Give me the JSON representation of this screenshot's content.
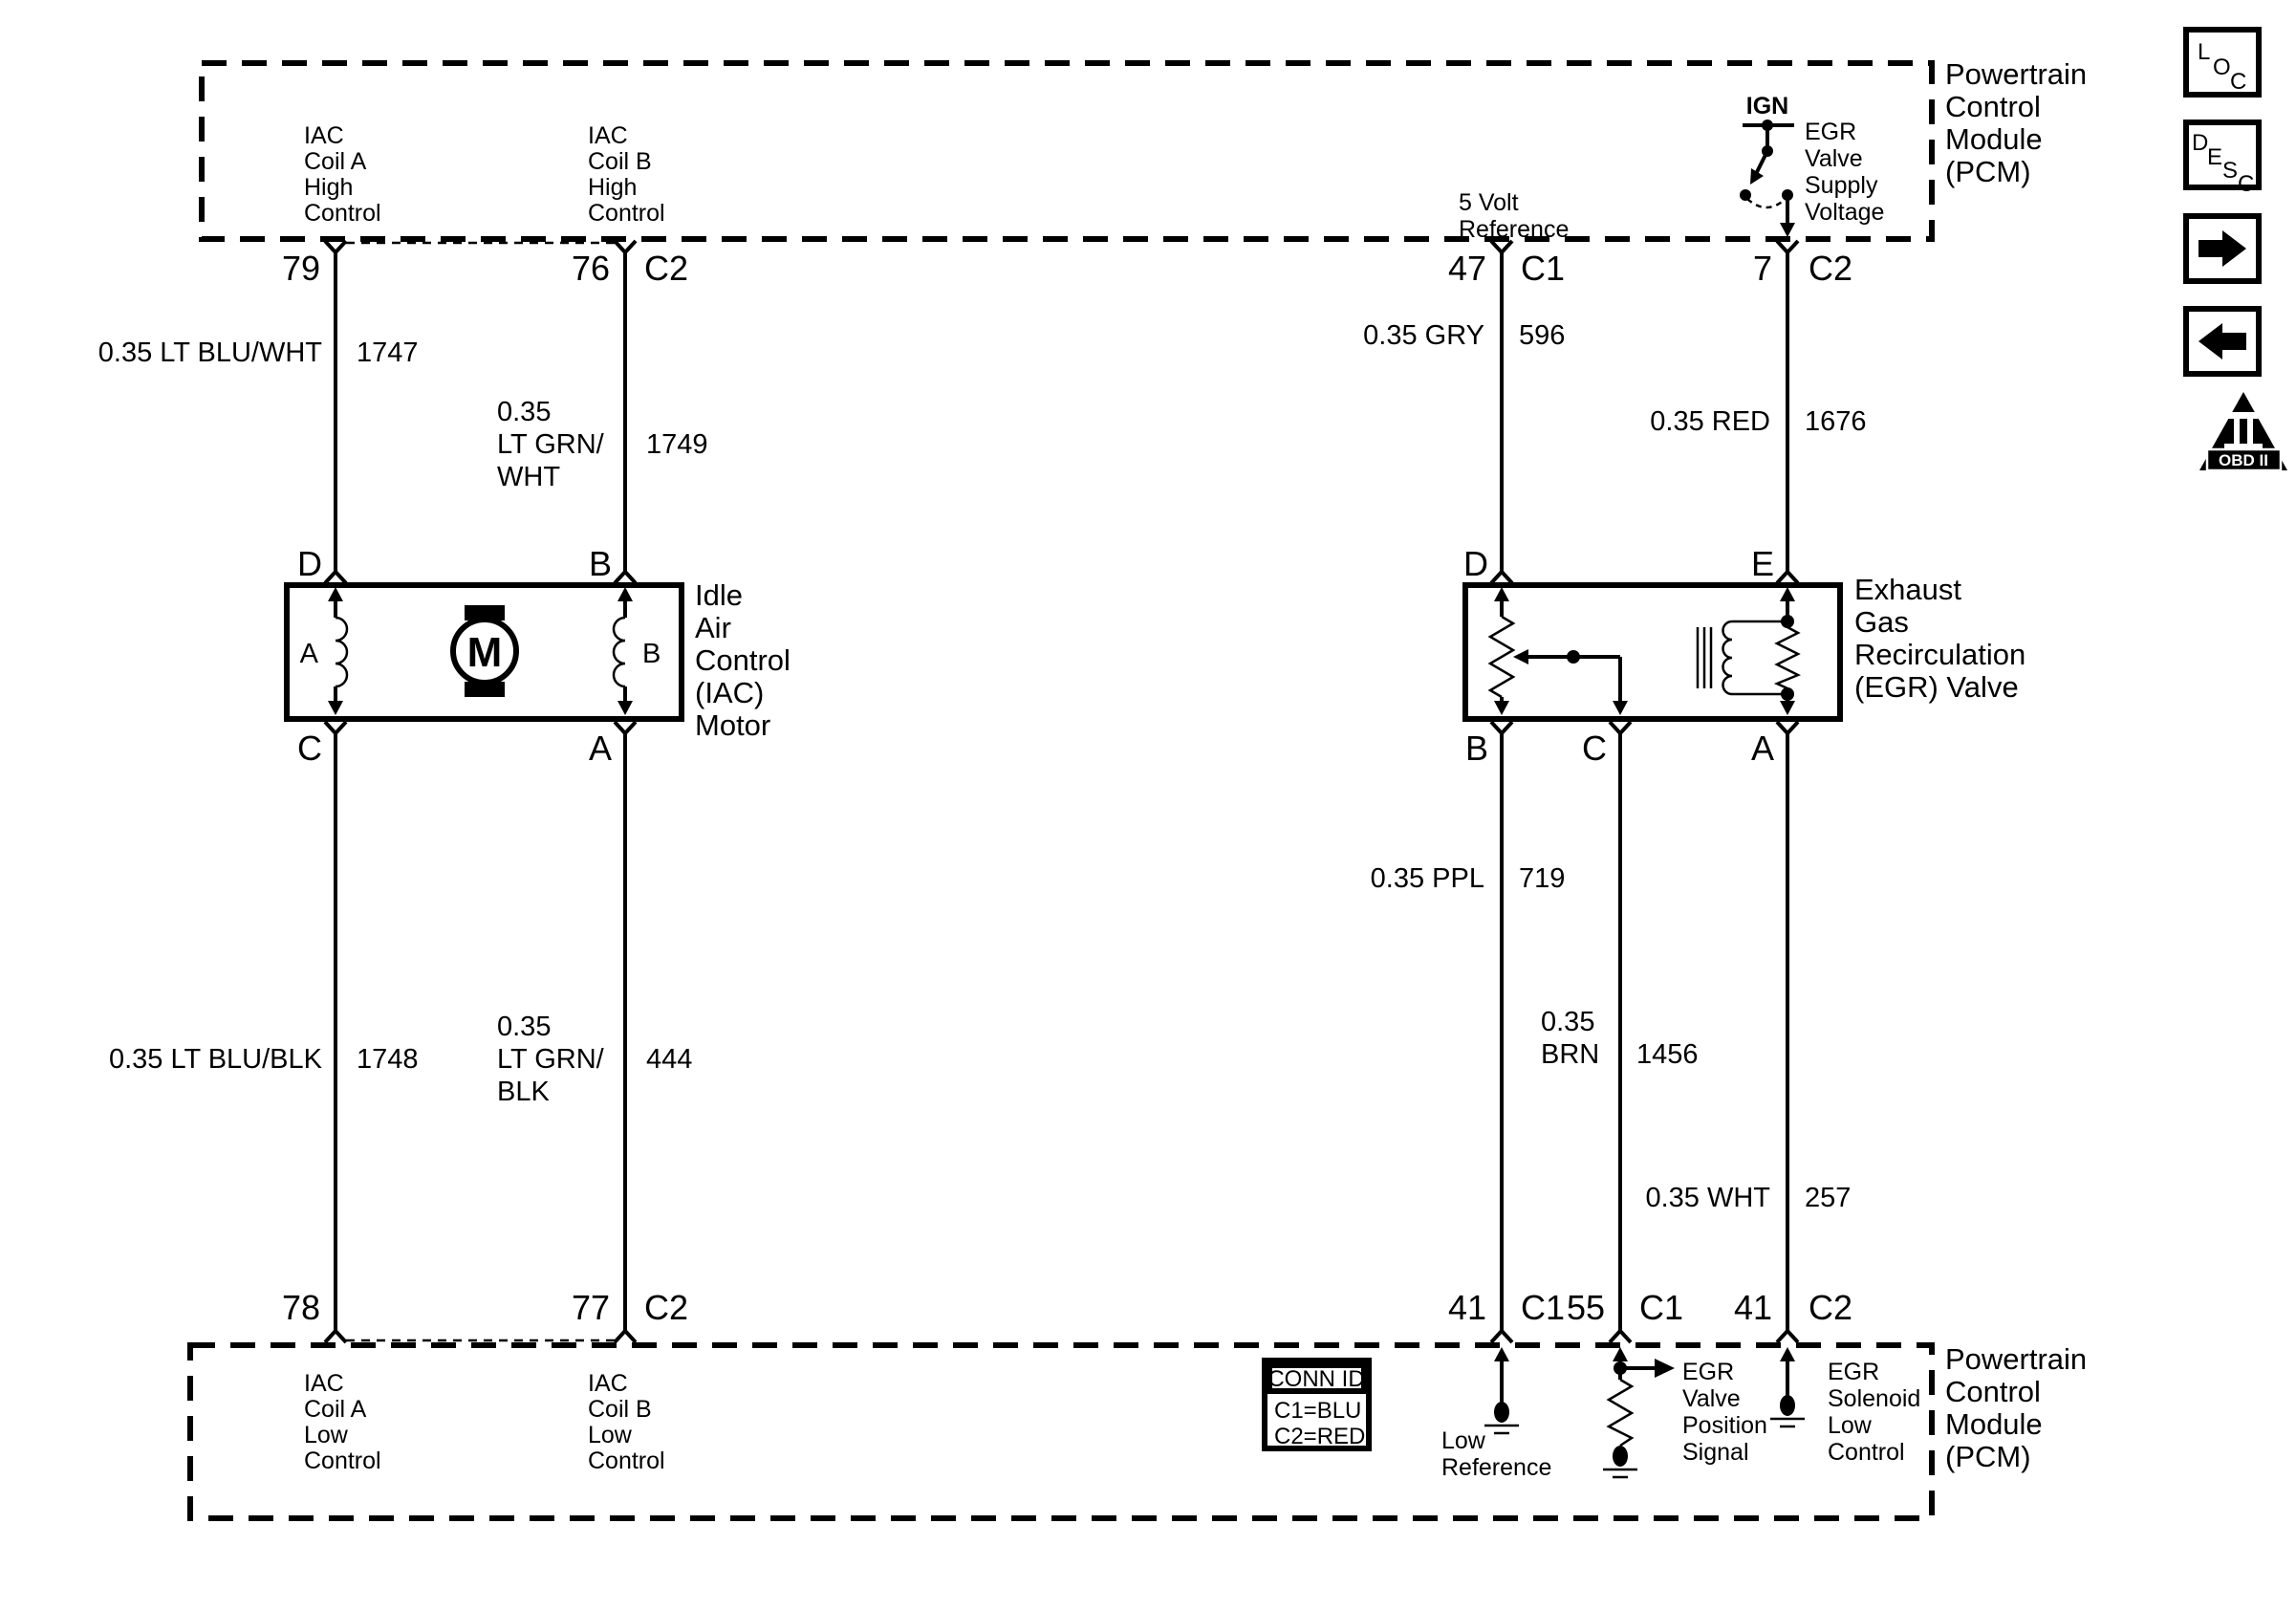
{
  "colors": {
    "ink": "#000000",
    "background": "#ffffff"
  },
  "pcm_top": {
    "label_lines": [
      "Powertrain",
      "Control",
      "Module",
      "(PCM)"
    ],
    "iac_coil_a_high": [
      "IAC",
      "Coil A",
      "High",
      "Control"
    ],
    "iac_coil_b_high": [
      "IAC",
      "Coil B",
      "High",
      "Control"
    ],
    "five_volt_ref": [
      "5 Volt",
      "Reference"
    ],
    "ign_label": "IGN",
    "egr_supply": [
      "EGR",
      "Valve",
      "Supply",
      "Voltage"
    ],
    "pins": {
      "p79": {
        "num": "79",
        "conn": ""
      },
      "p76": {
        "num": "76",
        "conn": "C2"
      },
      "p47": {
        "num": "47",
        "conn": "C1"
      },
      "p7": {
        "num": "7",
        "conn": "C2"
      }
    }
  },
  "wires": {
    "blu_wht": {
      "label": "0.35 LT BLU/WHT",
      "circuit": "1747"
    },
    "grn_wht": {
      "lines": [
        "0.35",
        "LT GRN/",
        "WHT"
      ],
      "circuit": "1749"
    },
    "gry": {
      "label": "0.35 GRY",
      "circuit": "596"
    },
    "red": {
      "label": "0.35 RED",
      "circuit": "1676"
    },
    "blu_blk": {
      "label": "0.35 LT BLU/BLK",
      "circuit": "1748"
    },
    "grn_blk": {
      "lines": [
        "0.35",
        "LT GRN/",
        "BLK"
      ],
      "circuit": "444"
    },
    "ppl": {
      "label": "0.35 PPL",
      "circuit": "719"
    },
    "brn": {
      "lines": [
        "0.35",
        "BRN"
      ],
      "circuit": "1456"
    },
    "wht": {
      "label": "0.35 WHT",
      "circuit": "257"
    }
  },
  "iac_motor": {
    "label_lines": [
      "Idle",
      "Air",
      "Control",
      "(IAC)",
      "Motor"
    ],
    "pins": {
      "top_left": "D",
      "top_right": "B",
      "bottom_left": "C",
      "bottom_right": "A"
    },
    "coil_a": "A",
    "coil_b": "B",
    "motor_letter": "M"
  },
  "egr_valve": {
    "label_lines": [
      "Exhaust",
      "Gas",
      "Recirculation",
      "(EGR) Valve"
    ],
    "pins": {
      "top_left": "D",
      "top_right": "E",
      "bottom_left": "B",
      "bottom_mid": "C",
      "bottom_right": "A"
    }
  },
  "pcm_bottom": {
    "label_lines": [
      "Powertrain",
      "Control",
      "Module",
      "(PCM)"
    ],
    "iac_coil_a_low": [
      "IAC",
      "Coil A",
      "Low",
      "Control"
    ],
    "iac_coil_b_low": [
      "IAC",
      "Coil B",
      "Low",
      "Control"
    ],
    "low_reference": [
      "Low",
      "Reference"
    ],
    "egr_position": [
      "EGR",
      "Valve",
      "Position",
      "Signal"
    ],
    "egr_solenoid_low": [
      "EGR",
      "Solenoid",
      "Low",
      "Control"
    ],
    "pins": {
      "p78": {
        "num": "78",
        "conn": ""
      },
      "p77": {
        "num": "77",
        "conn": "C2"
      },
      "p41a": {
        "num": "41",
        "conn": "C1"
      },
      "p55": {
        "num": "55",
        "conn": "C1"
      },
      "p41b": {
        "num": "41",
        "conn": "C2"
      }
    }
  },
  "conn_id": {
    "header": "CONN ID",
    "rows": [
      "C1=BLU",
      "C2=RED"
    ]
  },
  "toolbar": {
    "loc": [
      "L",
      "O",
      "C"
    ],
    "desc": [
      "D",
      "E",
      "S",
      "C"
    ],
    "obd": {
      "numeral": "II",
      "label": "OBD II"
    }
  }
}
